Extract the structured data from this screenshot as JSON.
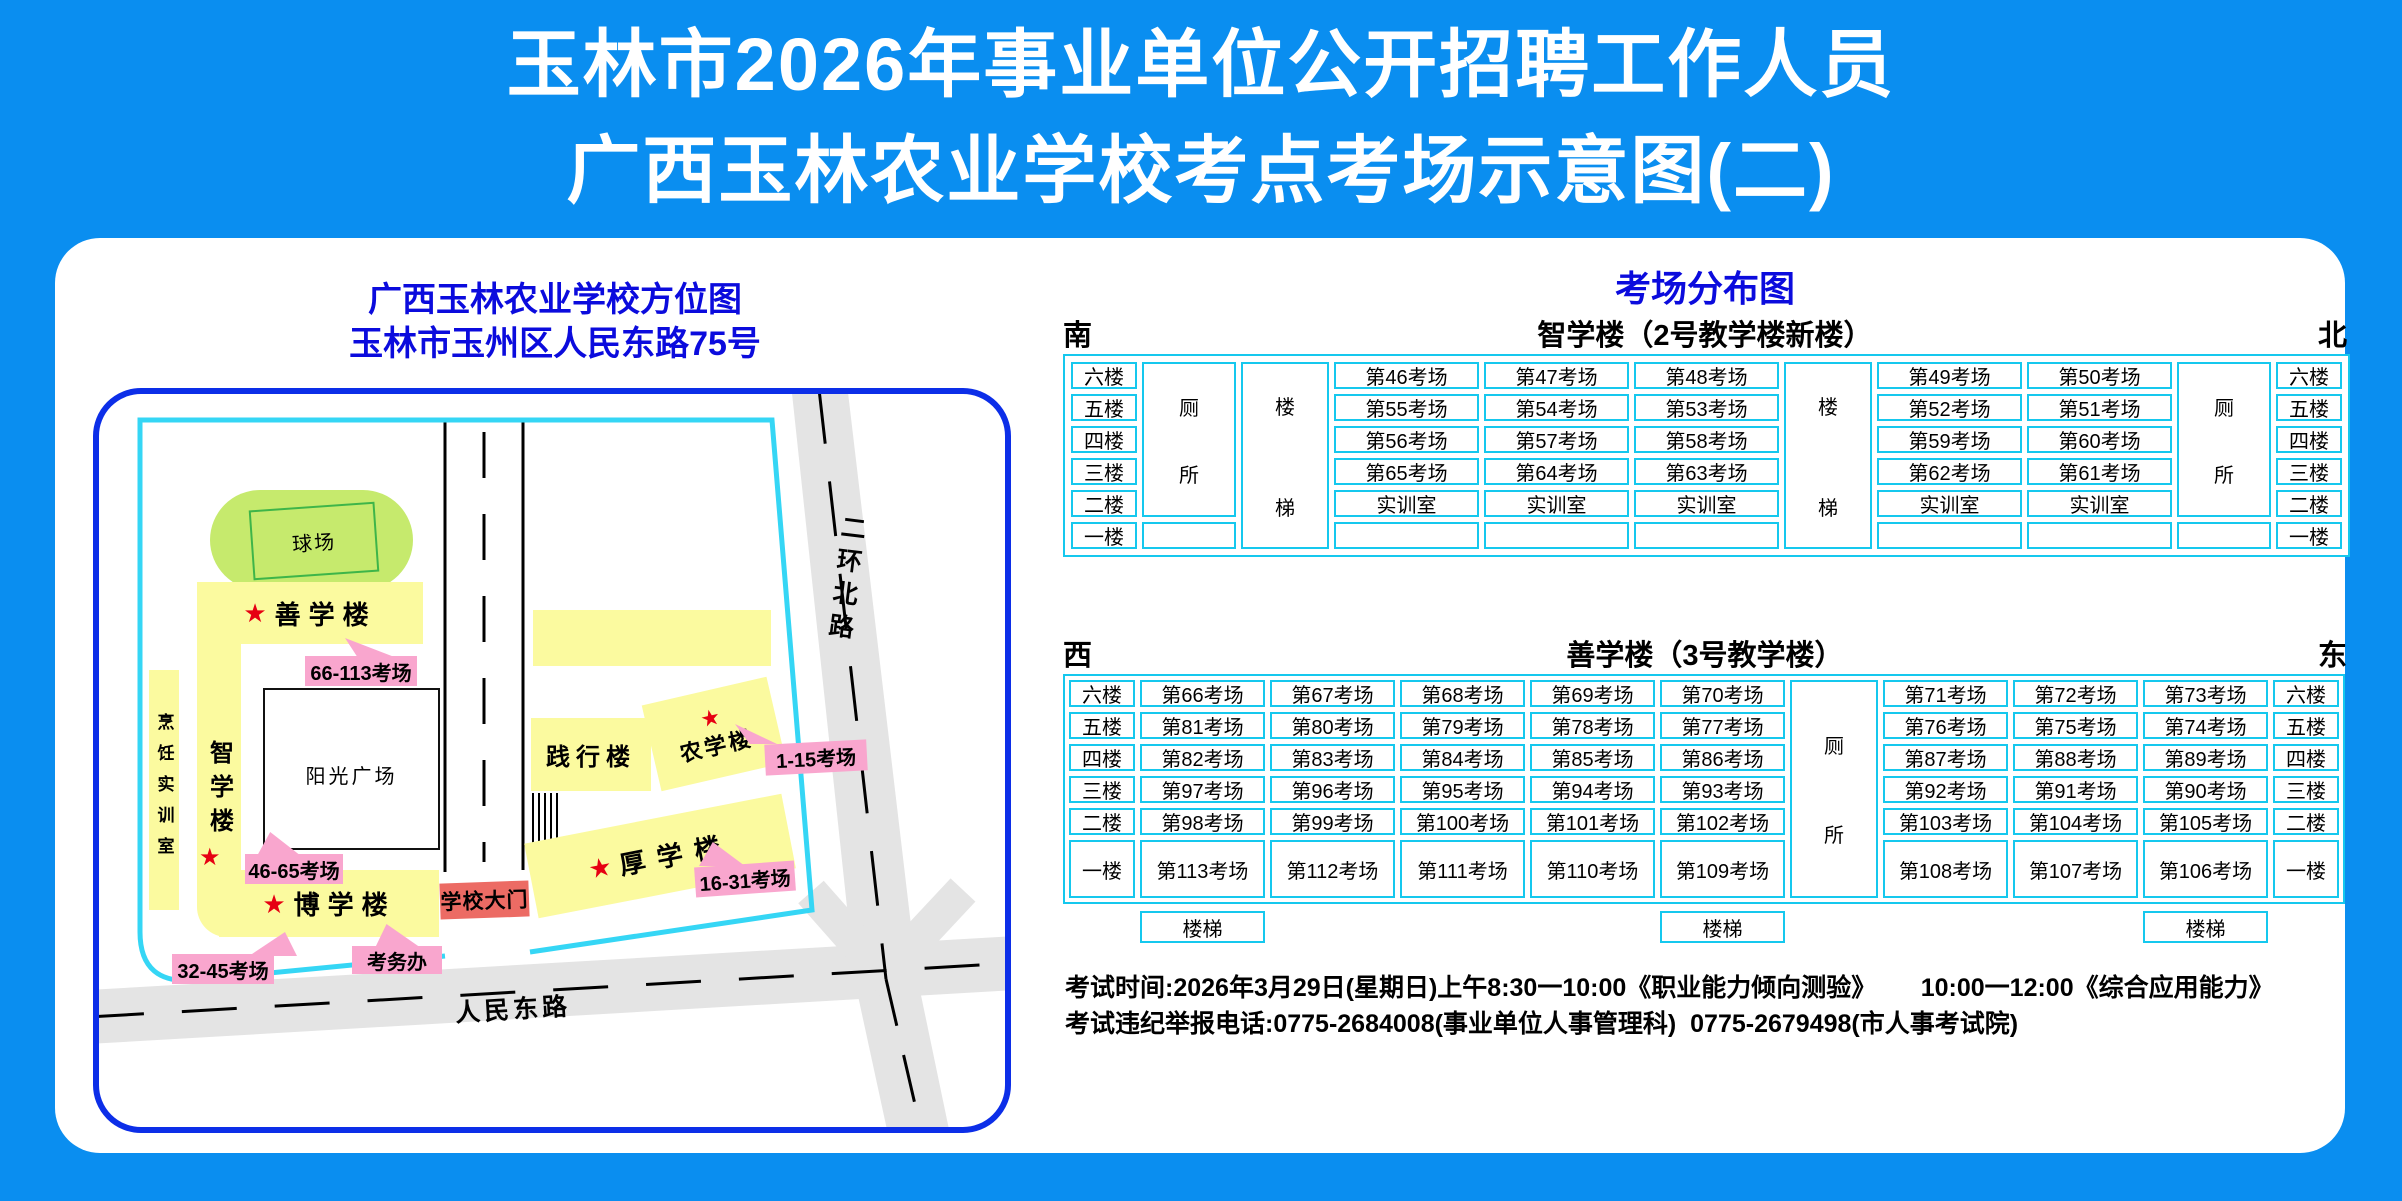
{
  "title": {
    "line1": "玉林市2026年事业单位公开招聘工作人员",
    "line2": "广西玉林农业学校考点考场示意图(二)"
  },
  "map": {
    "title_line1": "广西玉林农业学校方位图",
    "title_line2": "玉林市玉州区人民东路75号",
    "star": "★",
    "buildings": {
      "field": "球场",
      "shanxue": "善学楼",
      "zhixue": "智学楼",
      "pengren": "烹饪实训室",
      "plaza": "阳光广场",
      "boxue": "博学楼",
      "jianxing": "践行楼",
      "nongxue": "农学楼",
      "houxue": "厚学楼"
    },
    "labels": {
      "shanxue_rooms": "66-113考场",
      "zhixue_rooms": "46-65考场",
      "nongxue_rooms": "1-15考场",
      "houxue_rooms": "16-31考场",
      "boxue_rooms": "32-45考场",
      "kaowuban": "考务办",
      "gate": "学校大门"
    },
    "roads": {
      "renmin": "人民东路",
      "erhuan": "二环北路"
    },
    "colors": {
      "background_blue": "#0a8ef0",
      "map_border_blue": "#0c2ee8",
      "boundary_cyan": "#35d6f5",
      "table_cyan": "#15c8ee",
      "building_yellow": "#fbfa9f",
      "label_pink": "#f9a6ce",
      "gate_red": "#ec6b64",
      "star_red": "#e60012",
      "field_green": "#c6ea6d",
      "road_gray": "#e4e4e4",
      "heading_blue": "#0b0bdd"
    }
  },
  "distribution": {
    "title": "考场分布图",
    "toilet_chars": [
      "厕",
      "所"
    ],
    "stair_chars": [
      "楼",
      "梯"
    ],
    "table1": {
      "direction_left": "南",
      "direction_right": "北",
      "building": "智学楼（2号教学楼新楼）",
      "floors": [
        "六楼",
        "五楼",
        "四楼",
        "三楼",
        "二楼",
        "一楼"
      ],
      "left_rooms": [
        [
          "第46考场",
          "第47考场",
          "第48考场"
        ],
        [
          "第55考场",
          "第54考场",
          "第53考场"
        ],
        [
          "第56考场",
          "第57考场",
          "第58考场"
        ],
        [
          "第65考场",
          "第64考场",
          "第63考场"
        ],
        [
          "实训室",
          "实训室",
          "实训室"
        ],
        [
          "",
          "",
          ""
        ]
      ],
      "right_rooms": [
        [
          "第49考场",
          "第50考场"
        ],
        [
          "第52考场",
          "第51考场"
        ],
        [
          "第59考场",
          "第60考场"
        ],
        [
          "第62考场",
          "第61考场"
        ],
        [
          "实训室",
          "实训室"
        ],
        [
          "",
          ""
        ]
      ]
    },
    "table2": {
      "direction_left": "西",
      "direction_right": "东",
      "building": "善学楼（3号教学楼）",
      "floors": [
        "六楼",
        "五楼",
        "四楼",
        "三楼",
        "二楼",
        "一楼"
      ],
      "stairs_label": "楼梯",
      "left_rooms": [
        [
          "第66考场",
          "第67考场",
          "第68考场",
          "第69考场",
          "第70考场"
        ],
        [
          "第81考场",
          "第80考场",
          "第79考场",
          "第78考场",
          "第77考场"
        ],
        [
          "第82考场",
          "第83考场",
          "第84考场",
          "第85考场",
          "第86考场"
        ],
        [
          "第97考场",
          "第96考场",
          "第95考场",
          "第94考场",
          "第93考场"
        ],
        [
          "第98考场",
          "第99考场",
          "第100考场",
          "第101考场",
          "第102考场"
        ],
        [
          "第113考场",
          "第112考场",
          "第111考场",
          "第110考场",
          "第109考场"
        ]
      ],
      "right_rooms": [
        [
          "第71考场",
          "第72考场",
          "第73考场"
        ],
        [
          "第76考场",
          "第75考场",
          "第74考场"
        ],
        [
          "第87考场",
          "第88考场",
          "第89考场"
        ],
        [
          "第92考场",
          "第91考场",
          "第90考场"
        ],
        [
          "第103考场",
          "第104考场",
          "第105考场"
        ],
        [
          "第108考场",
          "第107考场",
          "第106考场"
        ]
      ]
    }
  },
  "footer": {
    "line1": "考试时间:2026年3月29日(星期日)上午8:30一10:00《职业能力倾向测验》　　 10:00一12:00《综合应用能力》",
    "line2": "考试违纪举报电话:0775-2684008(事业单位人事管理科)  0775-2679498(市人事考试院)"
  }
}
